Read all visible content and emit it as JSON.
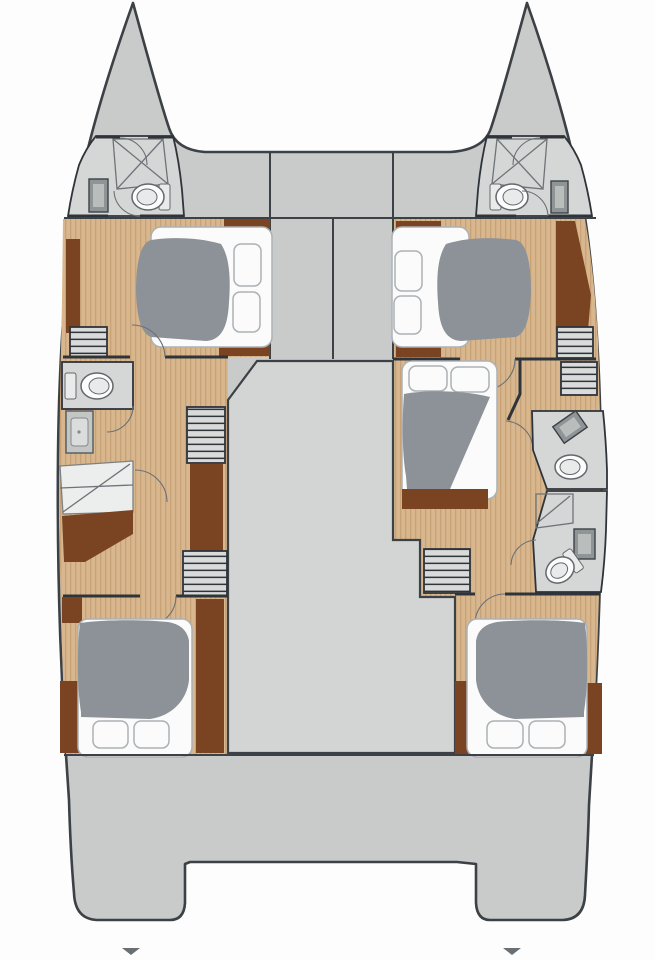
{
  "document": {
    "kind": "catamaran-floor-plan",
    "view": "top-down-deck-plan",
    "text_visible": ""
  },
  "colors": {
    "background": "#fdfdfd",
    "hull_outline": "#3c4146",
    "wall": "#2f343a",
    "deck": "#c8cbc9",
    "salon_block": "#d2d5d3",
    "bathroom_floor": "#d4d7d5",
    "wood_base": "#d9b78e",
    "wood_stripe": "#c8a277",
    "wood_trim": "#7a4423",
    "duvet": "#8c9298",
    "linen": "#fafbfa",
    "linen_stroke": "#acb1b5",
    "fixture_stroke": "#63686c",
    "steps_bg": "#d9dbda",
    "mark": "#6a6f73"
  },
  "plan": {
    "hulls": [
      "port-hull",
      "starboard-hull"
    ],
    "cabins": [
      {
        "id": "port-forward-cabin",
        "berth": "double",
        "pillows": 2
      },
      {
        "id": "starboard-forward-cabin",
        "berth": "double",
        "pillows": 2
      },
      {
        "id": "starboard-mid-cabin",
        "berth": "double",
        "pillows": 2
      },
      {
        "id": "port-aft-cabin",
        "berth": "double",
        "pillows": 2
      },
      {
        "id": "starboard-aft-cabin",
        "berth": "double",
        "pillows": 2
      }
    ],
    "heads": [
      {
        "id": "port-bow-head",
        "fixtures": [
          "shower",
          "toilet",
          "locker"
        ]
      },
      {
        "id": "starboard-bow-head",
        "fixtures": [
          "shower",
          "toilet",
          "washbasin"
        ]
      },
      {
        "id": "port-mid-head",
        "fixtures": [
          "toilet",
          "washbasin",
          "shower",
          "vanity-seat"
        ]
      },
      {
        "id": "starboard-mid-head",
        "fixtures": [
          "washbasin",
          "toilet"
        ]
      },
      {
        "id": "starboard-aft-head",
        "fixtures": [
          "shower",
          "washbasin",
          "toilet"
        ]
      }
    ],
    "common_areas": [
      "trampoline-gap",
      "foredeck",
      "salon-bridgedeck",
      "aft-deck",
      "port-transom",
      "starboard-transom"
    ],
    "stairs": [
      "port-forward-steps",
      "port-mid-steps",
      "port-aft-steps",
      "starboard-forward-steps",
      "starboard-mid-steps",
      "starboard-aft-steps"
    ]
  }
}
